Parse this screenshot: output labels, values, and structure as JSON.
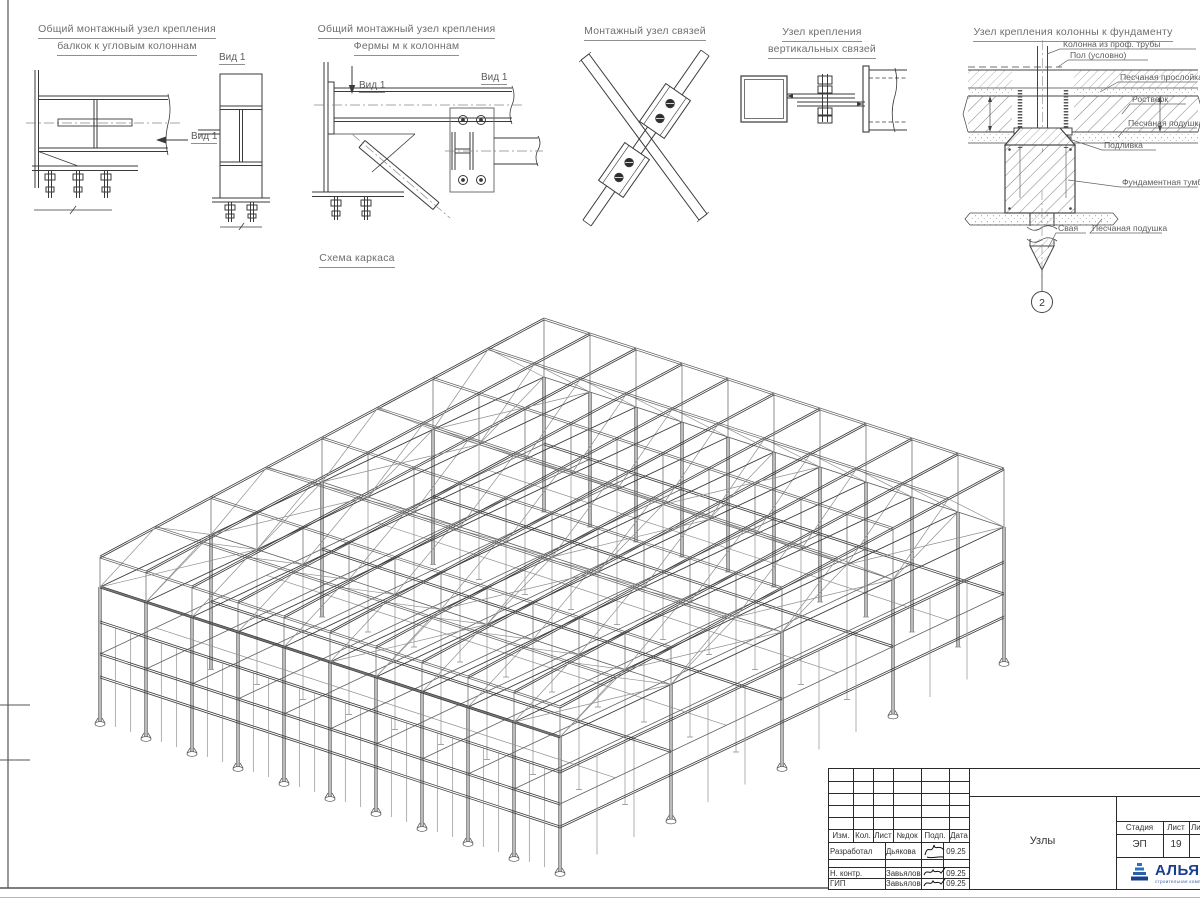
{
  "details": {
    "d1": {
      "title1": "Общий монтажный узел крепления",
      "title2": "балкок к угловым колоннам",
      "view": "Вид 1"
    },
    "d2": {
      "title1": "Общий монтажный узел крепления",
      "title2": "Фермы м к колоннам",
      "view": "Вид 1"
    },
    "d3": {
      "title": "Монтажный узел связей"
    },
    "d4": {
      "title1": "Узел крепления",
      "title2": "вертикальных связей"
    },
    "d5": {
      "title": "Узел крепления колонны к фундаменту",
      "labels": {
        "column": "Колонна из проф. трубы",
        "floor": "Пол (условно)",
        "sand_layer": "Песчаная прослойка",
        "rostverk": "Ростверк",
        "sand_pad1": "Песчаная подушка",
        "grout": "Подливка",
        "pedestal": "Фундаментная тумба",
        "pile": "Свая",
        "sand_pad2": "Песчаная подушка"
      },
      "marker": "2"
    }
  },
  "schema": {
    "title": "Схема каркаса"
  },
  "titleblock": {
    "cols": [
      "Изм.",
      "Кол.",
      "Лист",
      "№док",
      "Подп.",
      "Дата"
    ],
    "rows": [
      {
        "role": "Разработал",
        "name": "Дьякова",
        "date": "09.25"
      },
      {
        "role": "Н. контр.",
        "name": "Завьялова",
        "date": "09.25"
      },
      {
        "role": "ГИП",
        "name": "Завьялова",
        "date": "09.25"
      }
    ],
    "doc_name": "Узлы",
    "stage": {
      "headers": [
        "Стадия",
        "Лист",
        "Листов"
      ],
      "values": [
        "ЭП",
        "19",
        "2"
      ]
    },
    "logo": {
      "name": "АЛЬЯНС",
      "sub": "строительная компания",
      "color": "#1b3f8f"
    }
  },
  "frame_params": {
    "origin": [
      560,
      872
    ],
    "u": [
      -46,
      -15
    ],
    "nu": 10,
    "v": [
      111,
      -52.5
    ],
    "nv": 4,
    "eave": 135,
    "floor": 68,
    "girt1": 45,
    "girt2": 100,
    "truss": 30,
    "slope": 7
  }
}
